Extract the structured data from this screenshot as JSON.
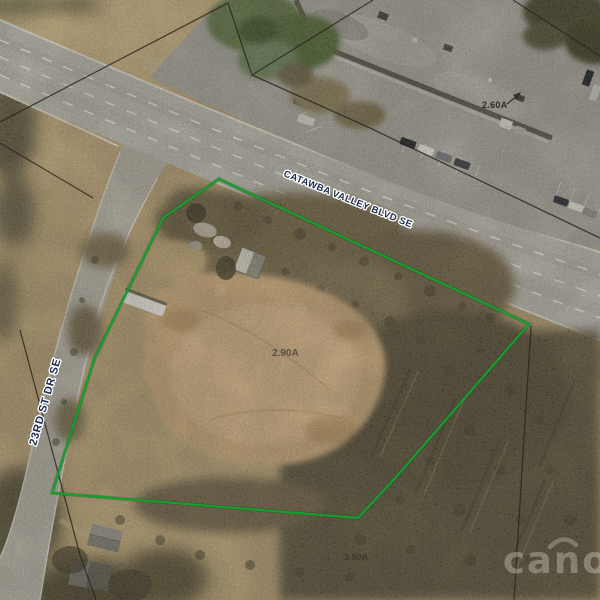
{
  "map": {
    "title": "Aerial parcel map",
    "road_labels": [
      {
        "id": "catawba-valley-blvd",
        "text": "CATAWBA VALLEY BLVD SE"
      },
      {
        "id": "23rd-st-dr",
        "text": "23RD ST DR SE"
      }
    ],
    "area_labels": [
      {
        "id": "subject-parcel-acreage",
        "text": "2.90A"
      },
      {
        "id": "north-parcel-acreage",
        "text": "2.60A"
      },
      {
        "id": "south-parcel-acreage",
        "text": "3.80A"
      }
    ],
    "watermark": {
      "text": "canopy"
    },
    "colors": {
      "parcel_outline_green": "#149f2e",
      "road_label_navy": "#1c2a4d",
      "area_label_gray": "#4d453a",
      "boundary_line_black": "#2b261d",
      "road_gray": "#bdbbb3",
      "dirt_tan": "#c0a878",
      "scrub_dark": "#5d553e"
    }
  }
}
